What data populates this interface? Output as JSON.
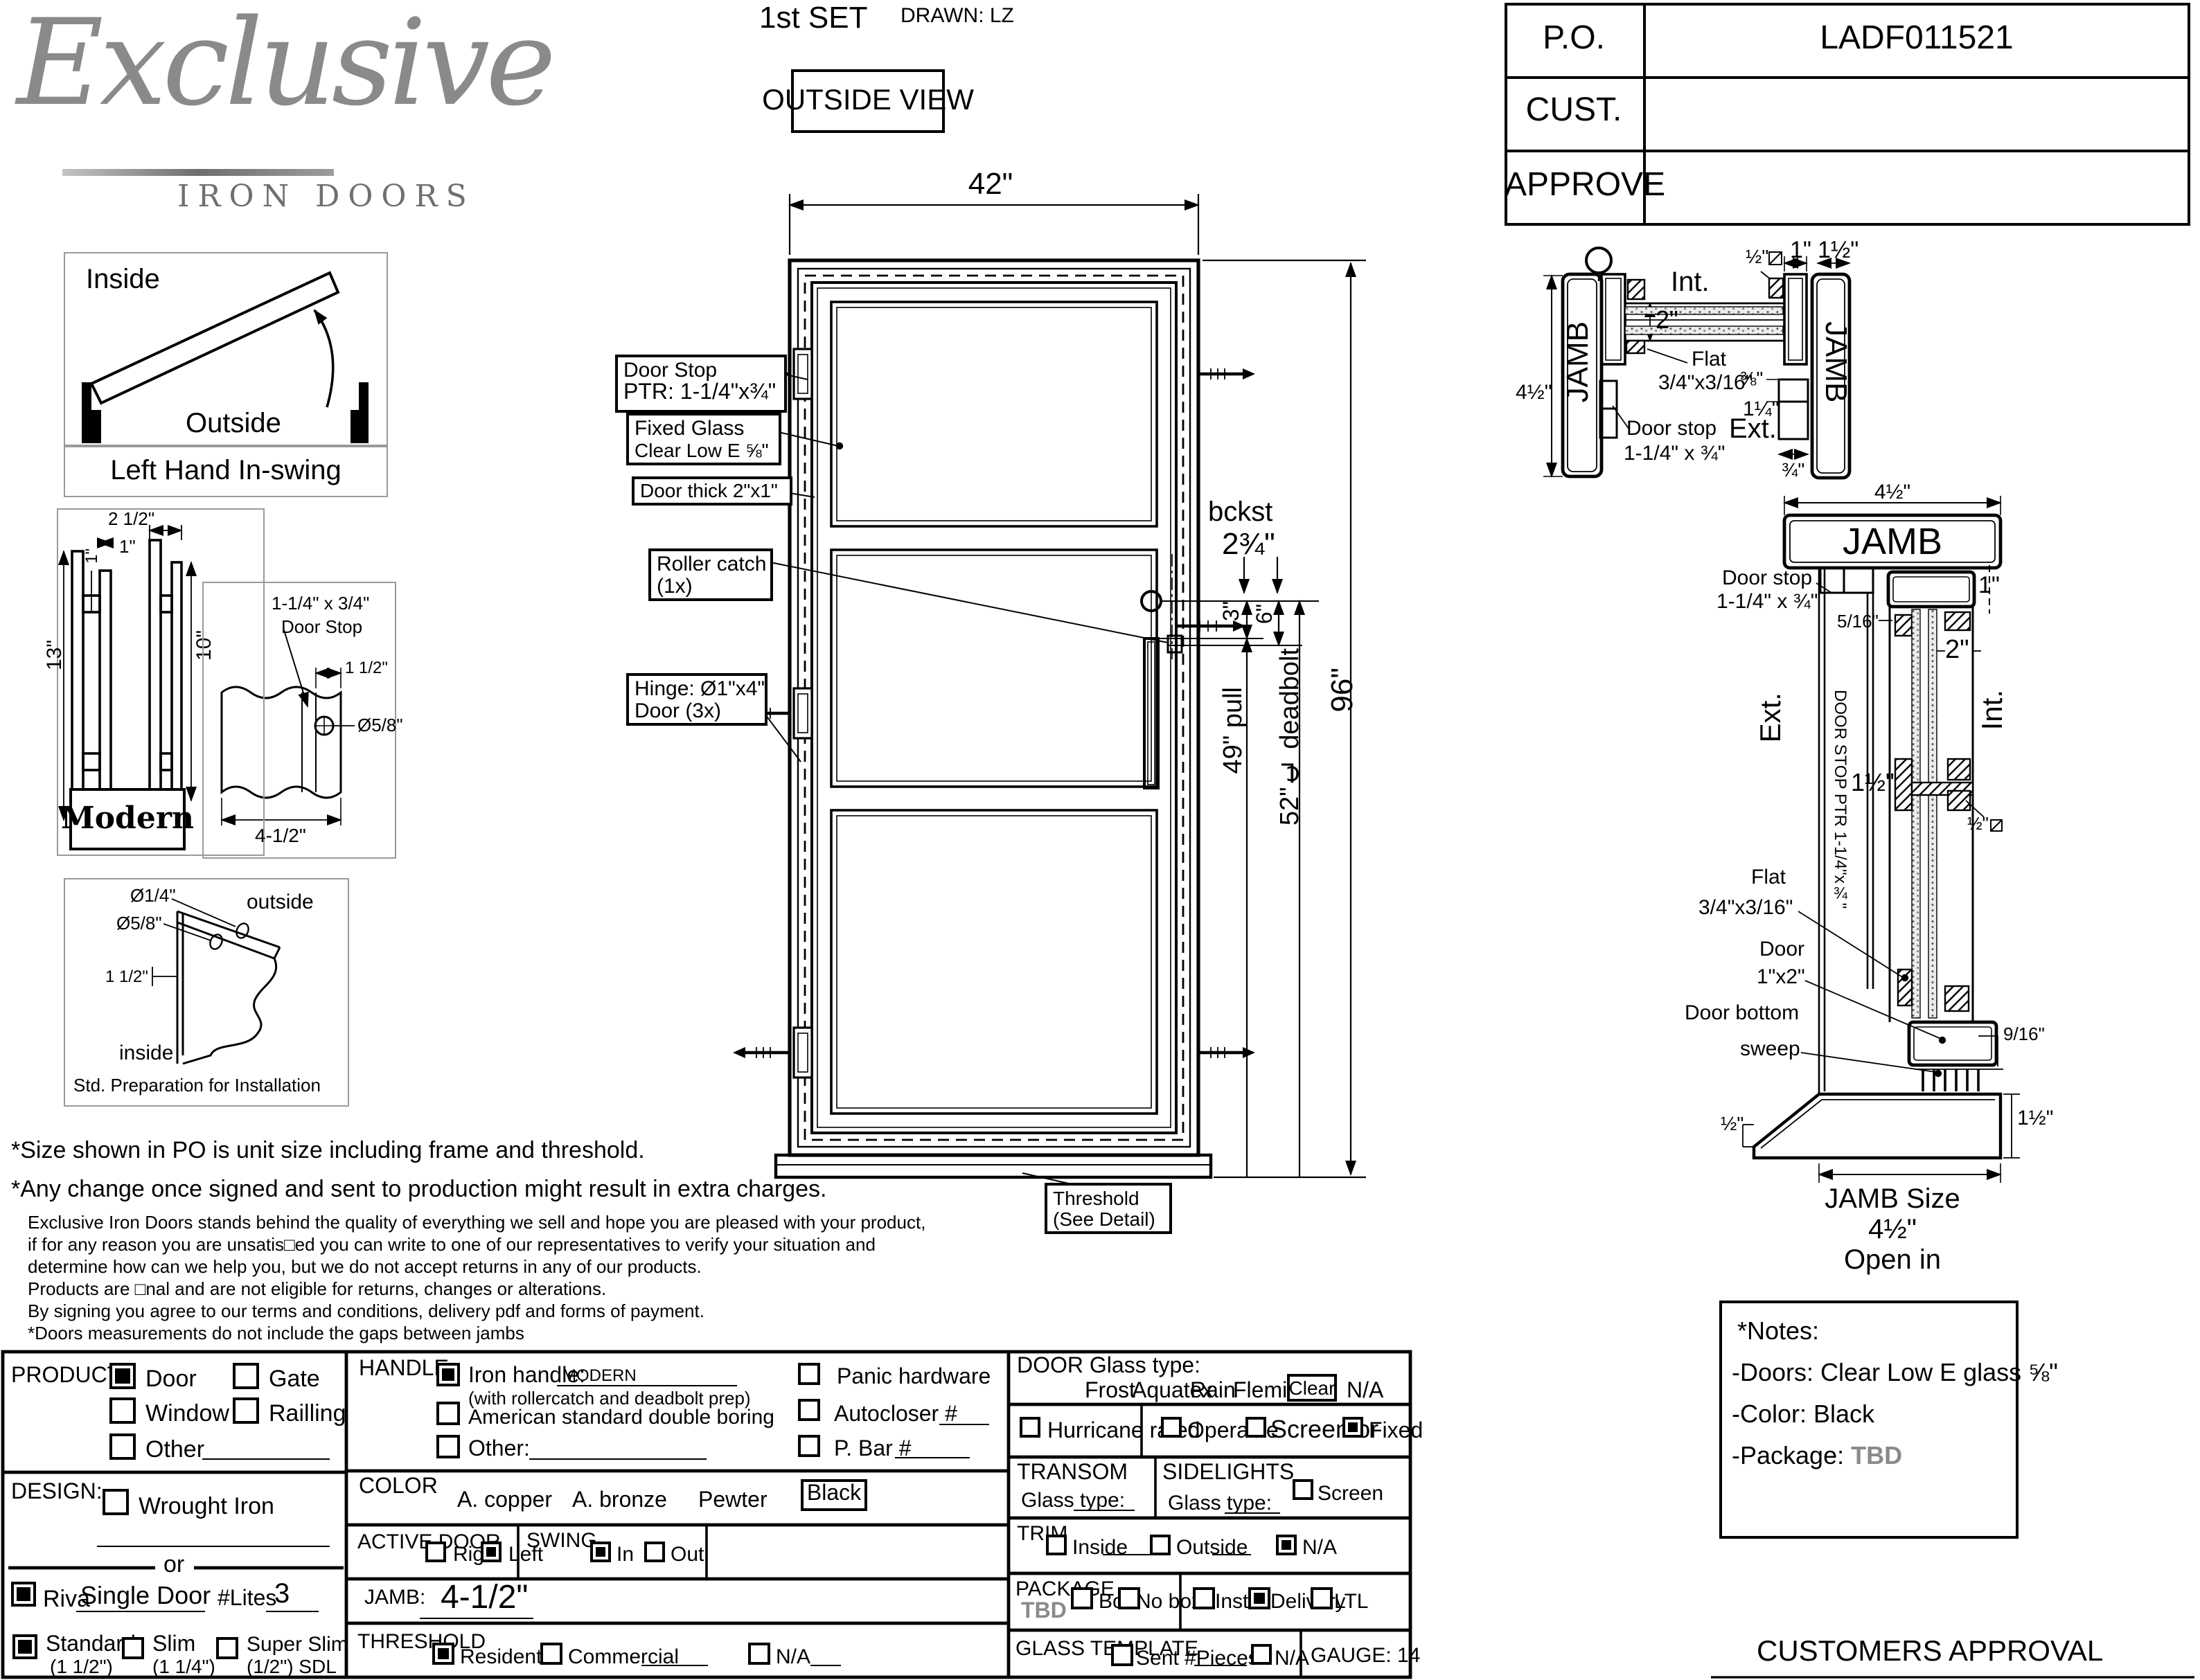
{
  "header": {
    "set": "1st SET",
    "drawn": "DRAWN: LZ",
    "view": "OUTSIDE VIEW"
  },
  "po": {
    "po_label": "P.O.",
    "po_value": "LADF011521",
    "cust_label": "CUST.",
    "approve_label": "APPROVE"
  },
  "logo": {
    "script": "Exclusive",
    "sub": "IRON DOORS"
  },
  "swing_diag": {
    "inside": "Inside",
    "outside": "Outside",
    "caption": "Left Hand In-swing"
  },
  "handle_diag": {
    "d_25": "2 1/2\"",
    "d_1a": "1\"",
    "d_1b": "1\"",
    "d_13": "13\"",
    "d_10": "10\"",
    "caption": "Modern"
  },
  "stop_diag": {
    "l1": "1-1/4\" x 3/4\"",
    "l2": "Door Stop",
    "d_15": "1 1/2\"",
    "d_58": "Ø5/8\"",
    "d_45": "4-1/2\""
  },
  "prep_diag": {
    "d_14": "Ø1/4\"",
    "d_58": "Ø5/8\"",
    "d_15": "1 1/2\"",
    "outside": "outside",
    "inside": "inside",
    "caption": "Std. Preparation for Installation"
  },
  "door": {
    "w": "42\"",
    "h": "96\"",
    "bckst": "bckst",
    "bckst_v": "2¾\"",
    "d3": "3\"",
    "d6": "6\"",
    "pull": "49\" pull",
    "deadbolt": "52\"℄ deadbolt",
    "co_stop1": "Door Stop",
    "co_stop2": "PTR: 1-1/4\"x¾\"",
    "co_glass1": "Fixed Glass",
    "co_glass2": "Clear Low E ⅝\"",
    "co_thick": "Door thick 2\"x1\"",
    "co_roller1": "Roller catch",
    "co_roller2": "(1x)",
    "co_hinge1": "Hinge: Ø1\"x4\"",
    "co_hinge2": "Door (3x)",
    "co_thresh1": "Threshold",
    "co_thresh2": "(See Detail)"
  },
  "jamb_head": {
    "jamb_l": "JAMB",
    "jamb_r": "JAMB",
    "d45": "4½\"",
    "d2": "2\"",
    "int": "Int.",
    "d12": "½\"",
    "d1": "1\"",
    "d112": "1½\"",
    "flat1": "Flat",
    "flat2": "3/4\"x3/16\"",
    "stop1": "Door stop",
    "stop2": "1-1/4\" x ¾\"",
    "d38": "⅜\"",
    "d114": "1¼\"",
    "ext": "Ext.",
    "d34": "¾\""
  },
  "jamb_sill": {
    "d45": "4½\"",
    "jamb": "JAMB",
    "stop1": "Door stop",
    "stop2": "1-1/4\" x ¾\"",
    "d516": "5/16\"",
    "d1": "1\"",
    "d2": "2\"",
    "ext": "Ext.",
    "int": "Int.",
    "vert": "DOOR STOP PTR 1-1/4\"x¾\"",
    "d112": "1½\"",
    "d12sq": "½\"",
    "flat1": "Flat",
    "flat2": "3/4\"x3/16\"",
    "door1": "Door",
    "door2": "1\"x2\"",
    "bottom1": "Door bottom",
    "bottom2": "sweep",
    "d916": "9/16\"",
    "d12": "½\"",
    "d112b": "1½\"",
    "size1": "JAMB Size",
    "size2": "4½\"",
    "open": "Open in"
  },
  "disclaimer": {
    "l1": "*Size shown in PO is unit size including frame and threshold.",
    "l2": "*Any change once signed and sent to production might result in extra charges.",
    "l3": "Exclusive Iron Doors stands behind the quality of everything we sell and hope you are pleased with your product,",
    "l4": "if for any reason you are unsatis□ed you can write to one of our representatives to verify your situation and",
    "l5": "determine how can we help you, but we do not accept returns in any of our products.",
    "l6": "Products are □nal and are not eligible for returns, changes or alterations.",
    "l7": "By signing you agree to our terms and conditions, delivery pdf and forms of payment.",
    "l8": "*Doors measurements do not include the gaps between jambs"
  },
  "notes": {
    "title": "*Notes:",
    "doors": "-Doors: Clear Low E glass ⅝\"",
    "color": "-Color: Black",
    "package": "-Package:",
    "package_v": "TBD"
  },
  "approval": "CUSTOMERS APPROVAL",
  "form": {
    "product": {
      "label": "PRODUCT:",
      "door": "Door",
      "door_checked": true,
      "gate": "Gate",
      "gate_checked": false,
      "window": "Window",
      "window_checked": false,
      "railling": "Railling",
      "railling_checked": false,
      "other": "Other",
      "other_checked": false
    },
    "design": {
      "label": "DESIGN:",
      "wrought": "Wrought Iron",
      "wrought_checked": false,
      "or": "or"
    },
    "riva": {
      "checked": true,
      "label": "Riva",
      "value": "Single Door",
      "lites_label": "#Lites",
      "lites_value": "3"
    },
    "thickness": {
      "std": "Standard",
      "std_sub": "(1 1/2\")",
      "std_checked": true,
      "slim": "Slim",
      "slim_sub": "(1 1/4\")",
      "slim_checked": false,
      "sslim": "Super Slim",
      "sslim_sub": "(1/2\") SDL",
      "sslim_checked": false
    },
    "handle": {
      "label": "HANDLE",
      "iron": "Iron handle:",
      "iron_value": "MODERN",
      "iron_checked": true,
      "note": "(with rollercatch and deadbolt prep)",
      "american": "American standard double boring",
      "american_checked": false,
      "other": "Other:",
      "other_checked": false,
      "panic": "Panic hardware",
      "panic_checked": false,
      "autocloser": "Autocloser #",
      "autocloser_checked": false,
      "pbar": "P. Bar #",
      "pbar_checked": false
    },
    "color": {
      "label": "COLOR",
      "copper": "A. copper",
      "bronze": "A. bronze",
      "pewter": "Pewter",
      "black": "Black"
    },
    "active": {
      "label": "ACTIVE DOOR",
      "right": "Right",
      "right_checked": false,
      "left": "Left",
      "left_checked": true
    },
    "swing": {
      "label": "SWING",
      "in": "In",
      "in_checked": true,
      "out": "Out",
      "out_checked": false
    },
    "jamb": {
      "label": "JAMB:",
      "value": "4-1/2\""
    },
    "threshold": {
      "label": "THRESHOLD",
      "residential": "Residential",
      "residential_checked": true,
      "commercial": "Commercial",
      "commercial_checked": false,
      "na": "N/A",
      "na_checked": false
    },
    "glass": {
      "label": "DOOR Glass type:",
      "frost": "Frost",
      "aquatex": "Aquatex",
      "rain": "Rain",
      "flemish": "Flemish",
      "clear": "Clear",
      "na": "N/A"
    },
    "row2": {
      "hurricane": "Hurricane rated",
      "hurricane_checked": false,
      "operable": "Operable",
      "operable_checked": false,
      "screen_or": "Screen or",
      "screen_checked": false,
      "fixed": "Fixed",
      "fixed_checked": true
    },
    "transom": {
      "label": "TRANSOM",
      "glass": "Glass type:"
    },
    "sidelights": {
      "label": "SIDELIGHTS",
      "glass": "Glass type:",
      "screen": "Screen",
      "screen_checked": false
    },
    "trim": {
      "label": "TRIM",
      "inside": "Inside",
      "inside_checked": false,
      "outside": "Outside",
      "outside_checked": false,
      "na": "N/A",
      "na_checked": true
    },
    "package": {
      "label": "PACKAGE",
      "tbd": "TBD",
      "box": "Box",
      "box_checked": false,
      "nobox": "No box",
      "nobox_checked": false,
      "install": "Install",
      "install_checked": false,
      "delivery": "Delivery",
      "delivery_checked": true,
      "ltl": "LTL",
      "ltl_checked": false
    },
    "template": {
      "label": "GLASS TEMPLATE",
      "sent": "Sent #Pieces",
      "sent_checked": false,
      "na": "N/A",
      "na_checked": false
    },
    "gauge": "GAUGE: 14"
  }
}
